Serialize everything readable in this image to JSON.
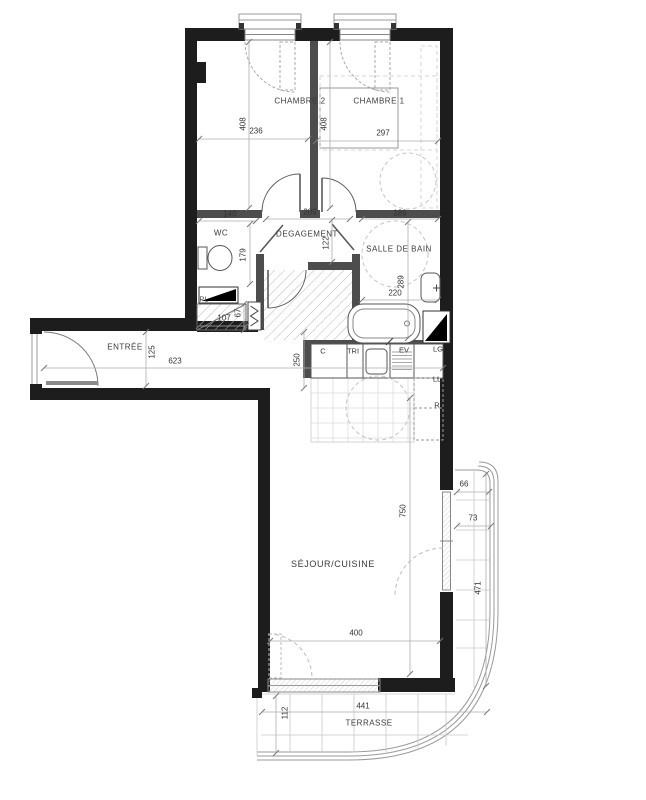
{
  "plan": {
    "title": "apartment-floor-plan",
    "colors": {
      "wall": "#1d1d1d",
      "partition": "#4d4d4d",
      "fixture_line": "#555555",
      "light_line": "#aeaeae",
      "dash_line": "#c4c4c4",
      "text": "#2e2e2e"
    },
    "rooms": [
      {
        "id": "chambre-2",
        "text": "CHAMBRE 2",
        "x": 300,
        "y": 101
      },
      {
        "id": "chambre-1",
        "text": "CHAMBRE 1",
        "x": 379,
        "y": 101
      },
      {
        "id": "wc",
        "text": "WC",
        "x": 221,
        "y": 233
      },
      {
        "id": "degagement",
        "text": "DEGAGEMENT",
        "x": 307,
        "y": 234
      },
      {
        "id": "salle-de-bain",
        "text": "SALLE DE BAIN",
        "x": 399,
        "y": 249
      },
      {
        "id": "pl",
        "text": "PL",
        "x": 204,
        "y": 300,
        "small": true
      },
      {
        "id": "entree",
        "text": "ENTRÉE",
        "x": 125,
        "y": 347
      },
      {
        "id": "sejour-cuisine",
        "text": "SÉJOUR/CUISINE",
        "x": 333,
        "y": 564,
        "big": true
      },
      {
        "id": "terrasse",
        "text": "TERRASSE",
        "x": 369,
        "y": 723
      }
    ],
    "dimensions": [
      {
        "id": "chambre2-h",
        "text": "408",
        "x": 243,
        "y": 124,
        "v": true
      },
      {
        "id": "chambre2-w",
        "text": "236",
        "x": 256,
        "y": 131
      },
      {
        "id": "chambre1-h",
        "text": "408",
        "x": 324,
        "y": 124,
        "v": true
      },
      {
        "id": "chambre1-w",
        "text": "297",
        "x": 383,
        "y": 133
      },
      {
        "id": "wc-w",
        "text": "140",
        "x": 230,
        "y": 214
      },
      {
        "id": "degagement-w",
        "text": "209",
        "x": 310,
        "y": 212
      },
      {
        "id": "sdb-door-w",
        "text": "189",
        "x": 400,
        "y": 213
      },
      {
        "id": "degagement-h",
        "text": "122",
        "x": 326,
        "y": 243,
        "v": true
      },
      {
        "id": "wc-h",
        "text": "179",
        "x": 243,
        "y": 255,
        "v": true
      },
      {
        "id": "sdb-h",
        "text": "289",
        "x": 401,
        "y": 282,
        "v": true
      },
      {
        "id": "sdb-w",
        "text": "220",
        "x": 395,
        "y": 293
      },
      {
        "id": "pl-w",
        "text": "107",
        "x": 224,
        "y": 318
      },
      {
        "id": "pl-h",
        "text": "67",
        "x": 238,
        "y": 313,
        "v": true
      },
      {
        "id": "hall-h",
        "text": "250",
        "x": 297,
        "y": 360,
        "v": true
      },
      {
        "id": "entree-h",
        "text": "125",
        "x": 152,
        "y": 352,
        "v": true
      },
      {
        "id": "entree-w",
        "text": "623",
        "x": 175,
        "y": 361
      },
      {
        "id": "sejour-h",
        "text": "750",
        "x": 403,
        "y": 511,
        "v": true
      },
      {
        "id": "sejour-w",
        "text": "400",
        "x": 356,
        "y": 633
      },
      {
        "id": "terrace-right-top",
        "text": "66",
        "x": 464,
        "y": 484
      },
      {
        "id": "terrace-right-w",
        "text": "73",
        "x": 473,
        "y": 518
      },
      {
        "id": "terrace-right-h",
        "text": "471",
        "x": 478,
        "y": 588,
        "v": true
      },
      {
        "id": "terrasse-w",
        "text": "441",
        "x": 363,
        "y": 706
      },
      {
        "id": "terrasse-h",
        "text": "112",
        "x": 285,
        "y": 713,
        "v": true
      }
    ],
    "appliances": [
      {
        "id": "cooker",
        "text": "C",
        "x": 323,
        "y": 351
      },
      {
        "id": "tri",
        "text": "TRI",
        "x": 353,
        "y": 351
      },
      {
        "id": "evier",
        "text": "EV",
        "x": 404,
        "y": 350
      },
      {
        "id": "lg",
        "text": "LG",
        "x": 438,
        "y": 349
      },
      {
        "id": "lave-linge",
        "text": "LL",
        "x": 437,
        "y": 379
      },
      {
        "id": "refrigerateur",
        "text": "R",
        "x": 437,
        "y": 405
      }
    ]
  }
}
